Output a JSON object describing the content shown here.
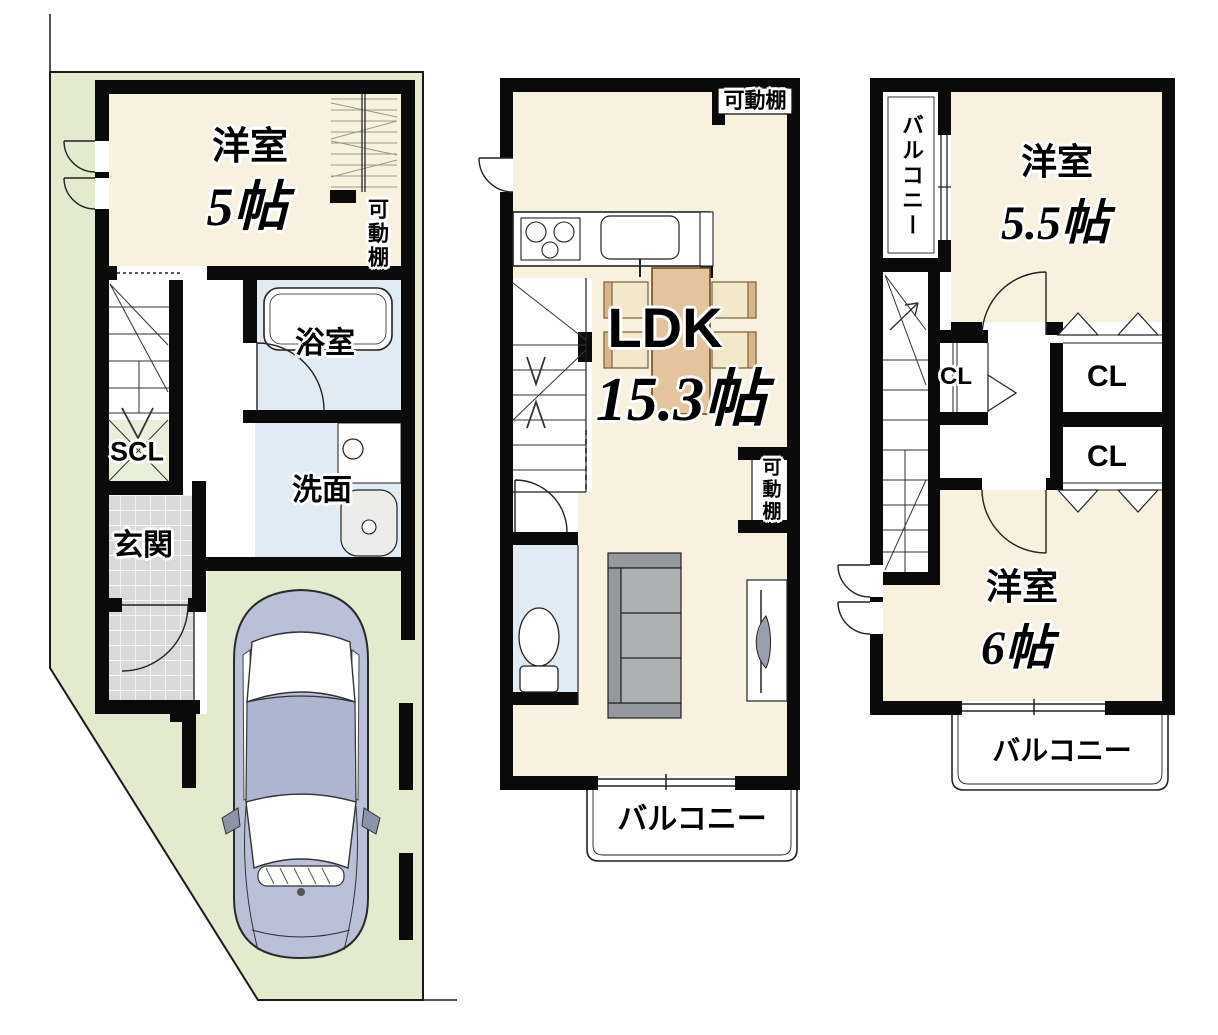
{
  "floor1": {
    "room_label": "洋室",
    "room_size": "5帖",
    "shelf_label": "可動棚",
    "bath_label": "浴室",
    "wash_label": "洗面",
    "shoe_closet_label": "SCL",
    "entrance_label": "玄関"
  },
  "floor2": {
    "shelf_top_label": "可動棚",
    "ldk_label": "LDK",
    "ldk_size": "15.3帖",
    "shelf_side_label": "可動棚",
    "balcony_label": "バルコニー"
  },
  "floor3": {
    "balcony_side_label": "バルコニー",
    "room1_label": "洋室",
    "room1_size": "5.5帖",
    "closet1_label": "CL",
    "closet2_label": "CL",
    "closet3_label": "CL",
    "room2_label": "洋室",
    "room2_size": "6帖",
    "balcony_bottom_label": "バルコニー"
  },
  "colors": {
    "wall": "#0a0a0a",
    "lot_green": "#e3eacd",
    "room_cream": "#f8f1df",
    "water_blue": "#e0ebf4",
    "scl_green": "#e9efdb",
    "tile_gray": "#d9d9d9",
    "car_body": "#bac0d8",
    "table_tan": "#e3c49d",
    "chair_cream": "#f4e8cb",
    "sofa_gray": "#aeb1b4"
  }
}
